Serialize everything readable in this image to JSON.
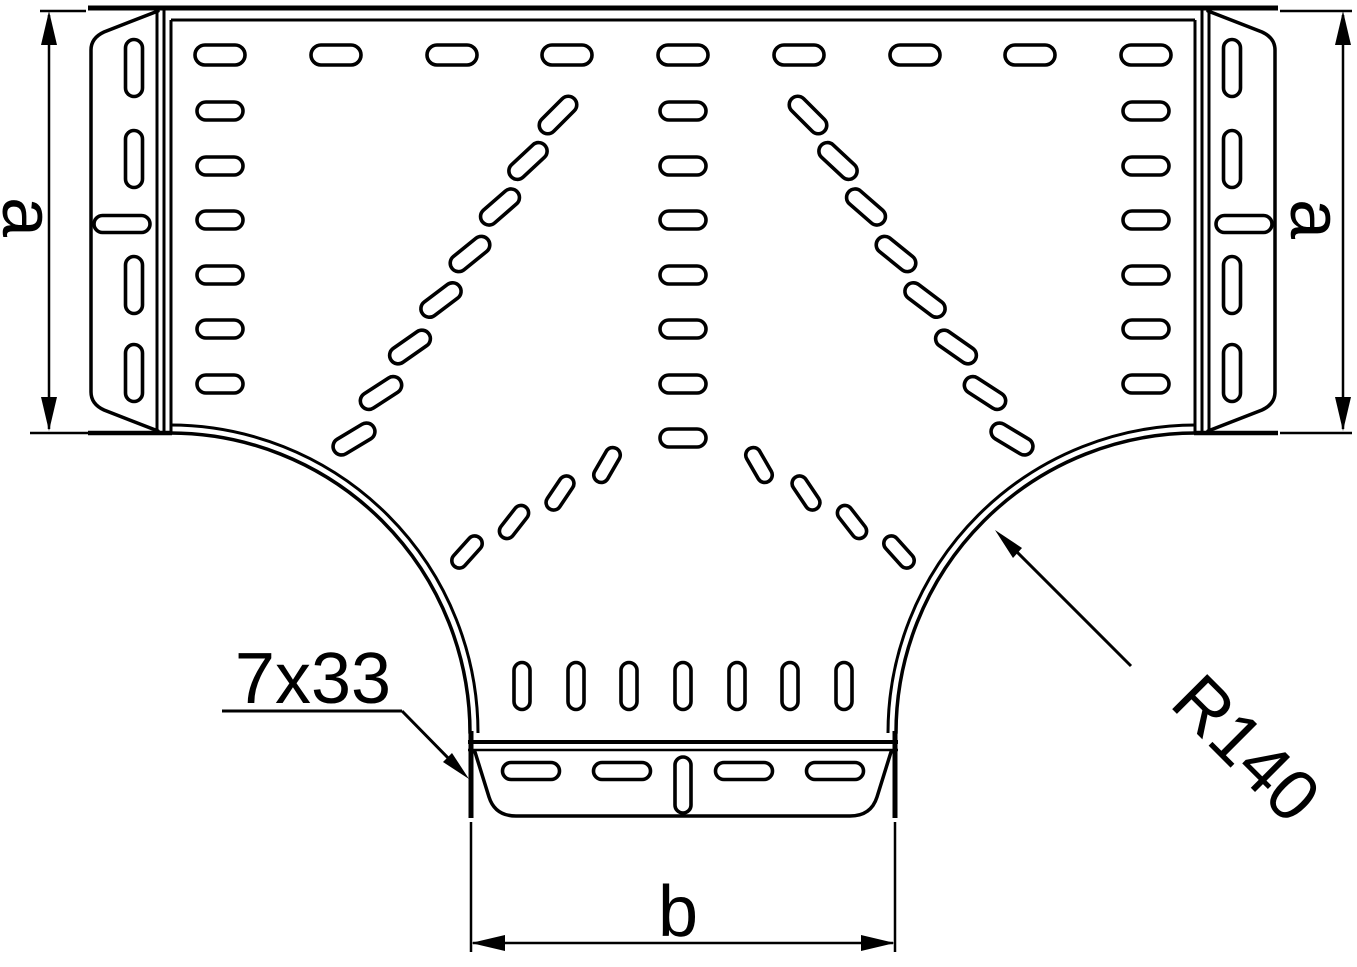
{
  "drawing": {
    "labels": {
      "dim_a_left": "a",
      "dim_a_right": "a",
      "dim_b": "b",
      "slot_note": "7x33",
      "radius_note": "R140"
    },
    "colors": {
      "line": "#000000",
      "background": "#ffffff"
    }
  }
}
